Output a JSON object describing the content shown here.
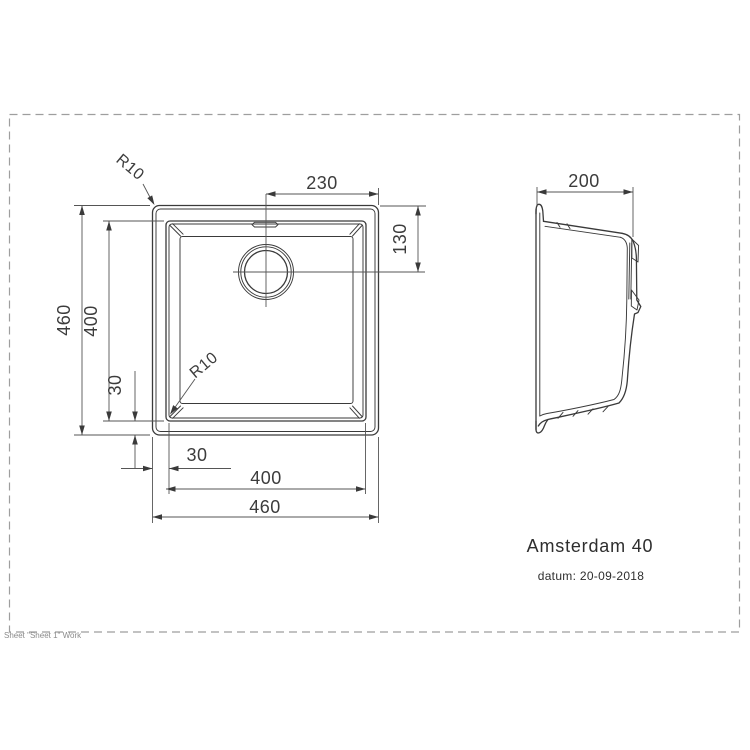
{
  "page": {
    "sheet_footer": "Sheet \"Sheet 1\" Work"
  },
  "title_block": {
    "model_name": "Amsterdam 40",
    "date_line": "datum: 20-09-2018"
  },
  "front_view": {
    "dimensions": {
      "drain_center_from_right": "230",
      "drain_center_from_top": "130",
      "outer_height": "460",
      "bowl_height": "400",
      "bowl_bottom_offset": "30",
      "bowl_left_offset": "30",
      "bowl_width": "400",
      "outer_width": "460",
      "outer_corner_radius": "R10",
      "bowl_corner_radius": "R10"
    }
  },
  "side_view": {
    "dimensions": {
      "depth": "200"
    }
  },
  "colors": {
    "object_line": "#3a3a3a",
    "dimension_line": "#555555",
    "sheet_border": "#9e9e9e",
    "label_text": "#3c3c3c",
    "footer_text": "#8a8a8a",
    "background": "#ffffff"
  }
}
